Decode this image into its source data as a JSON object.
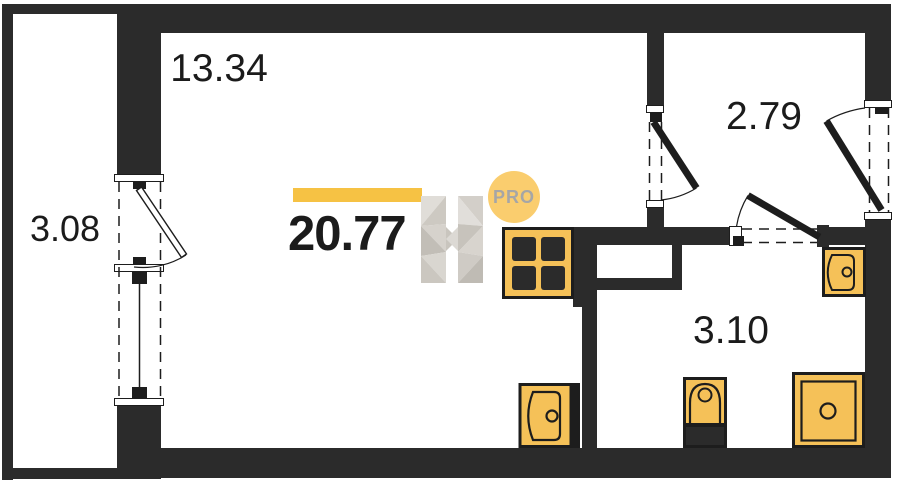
{
  "plan": {
    "total_area": "20.77",
    "badge_label": "PRO",
    "rooms": [
      {
        "name": "balcony",
        "area": "3.08"
      },
      {
        "name": "living-room",
        "area": "13.34"
      },
      {
        "name": "hallway",
        "area": "2.79"
      },
      {
        "name": "bathroom",
        "area": "3.10"
      }
    ],
    "fixtures": [
      "stove-icon",
      "kitchen-sink-icon",
      "bathroom-sink-icon",
      "toilet-icon",
      "shower-icon"
    ],
    "openings": [
      "balcony-door",
      "balcony-window",
      "living-hallway-door",
      "bathroom-door",
      "entrance-door"
    ],
    "colors": {
      "wall": "#2B2B2B",
      "line": "#1D1D1D",
      "fixture": "#F5C158",
      "accent_bar": "#F6C244",
      "badge_bg": "#FACD6E",
      "badge_text": "#A6A6A6",
      "text": "#1B1B1B"
    }
  }
}
